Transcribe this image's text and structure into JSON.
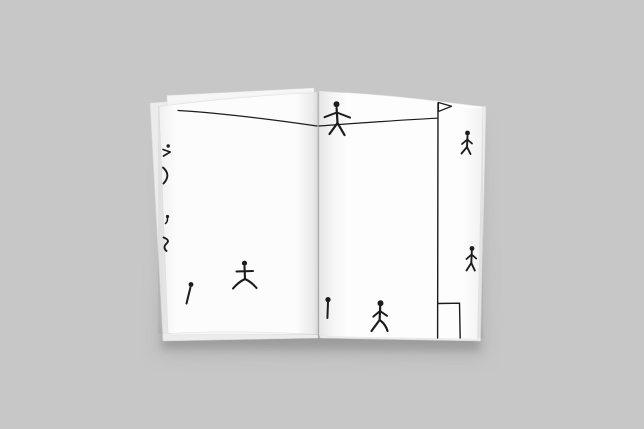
{
  "scene": {
    "description": "Photograph of an open white sketchbook on a gray surface, pages covered with small hand-drawn black stick figures, a rope line, a pennant flag on a pole and a small goal box",
    "background_color": "#c7c7c7",
    "page_color": "#fcfcfc",
    "page_color_right": "#fdfdfd",
    "under_page_color": "#ececec",
    "upper_back_page_color": "#f6f6f6",
    "ink_color": "#1c1c1c"
  },
  "drawing": {
    "elements": [
      {
        "name": "rope-line-left-page",
        "strokes": [
          {
            "kind": "path",
            "d": "M178,110.5 C220,113 272,119.5 317,126",
            "w": 1.2
          }
        ]
      },
      {
        "name": "rope-line-right-page",
        "strokes": [
          {
            "kind": "path",
            "d": "M319,126 C360,123 400,120 437,118.2",
            "w": 1.2
          }
        ]
      },
      {
        "name": "tightrope-walker-figure",
        "strokes": [
          {
            "kind": "dot",
            "cx": 336.5,
            "cy": 104.2,
            "r": 3
          },
          {
            "kind": "path",
            "d": "M336.6,108 L337.5,123",
            "w": 2.2
          },
          {
            "kind": "path",
            "d": "M324.5,117.2 L336.8,112.5 L350,117.6",
            "w": 2.0
          },
          {
            "kind": "path",
            "d": "M337.5,123 L329.5,134",
            "w": 2.2
          },
          {
            "kind": "path",
            "d": "M337.5,123 L344.5,135",
            "w": 2.2
          }
        ]
      },
      {
        "name": "flag-pole",
        "strokes": [
          {
            "kind": "path",
            "d": "M438,103 L437.6,338",
            "w": 1.4
          }
        ]
      },
      {
        "name": "flag-pennant",
        "strokes": [
          {
            "kind": "path",
            "d": "M438.4,102.5 L451.5,106.3 L438.4,111.5 Z",
            "w": 1.3,
            "fill": "#ffffff"
          }
        ]
      },
      {
        "name": "goal-box-lines",
        "strokes": [
          {
            "kind": "path",
            "d": "M438,303.5 L459.5,303.2 L460.2,338",
            "w": 1.4
          }
        ]
      },
      {
        "name": "pin-figure",
        "strokes": [
          {
            "kind": "dot",
            "cx": 328,
            "cy": 299.6,
            "r": 2.6
          },
          {
            "kind": "path",
            "d": "M328,302.5 L327.4,318",
            "w": 2.0
          }
        ]
      },
      {
        "name": "running-figure-bottom",
        "strokes": [
          {
            "kind": "dot",
            "cx": 380.5,
            "cy": 303.2,
            "r": 3
          },
          {
            "kind": "path",
            "d": "M380.2,306.5 L379.6,320",
            "w": 2.2
          },
          {
            "kind": "path",
            "d": "M380,311 L373.3,316.6",
            "w": 2.0
          },
          {
            "kind": "path",
            "d": "M380,311 L387,315.8",
            "w": 2.0
          },
          {
            "kind": "path",
            "d": "M379.6,320 L371.5,331",
            "w": 2.2
          },
          {
            "kind": "path",
            "d": "M379.6,320 Q385.5,324 387.5,331",
            "w": 2.2
          }
        ]
      },
      {
        "name": "wide-stance-figure",
        "strokes": [
          {
            "kind": "dot",
            "cx": 244.5,
            "cy": 263.2,
            "r": 2.6
          },
          {
            "kind": "path",
            "d": "M244.5,266.5 L245,279",
            "w": 2.1
          },
          {
            "kind": "path",
            "d": "M236.5,271.5 L253,271",
            "w": 2.0
          },
          {
            "kind": "path",
            "d": "M245,279 Q238.5,282 233,288.5",
            "w": 2.1
          },
          {
            "kind": "path",
            "d": "M245,279 Q251.5,282 256.5,288",
            "w": 2.1
          }
        ]
      },
      {
        "name": "leaning-line-figure",
        "strokes": [
          {
            "kind": "dot",
            "cx": 191,
            "cy": 284.5,
            "r": 2.4
          },
          {
            "kind": "path",
            "d": "M190.4,287.5 L186.5,303.5",
            "w": 2.0
          }
        ]
      },
      {
        "name": "edge-runner-figure-top",
        "strokes": [
          {
            "kind": "dot",
            "cx": 467.5,
            "cy": 133,
            "r": 2.4
          },
          {
            "kind": "path",
            "d": "M467.5,136 L467,147",
            "w": 1.9
          },
          {
            "kind": "path",
            "d": "M467.3,139.5 L462,144",
            "w": 1.8
          },
          {
            "kind": "path",
            "d": "M467.3,139.5 L472,143.5",
            "w": 1.8
          },
          {
            "kind": "path",
            "d": "M467,147 L461.5,153.5",
            "w": 1.9
          },
          {
            "kind": "path",
            "d": "M467,147 L470.5,154",
            "w": 1.9
          }
        ]
      },
      {
        "name": "edge-walker-figure-bottom",
        "strokes": [
          {
            "kind": "dot",
            "cx": 472,
            "cy": 248.5,
            "r": 2.4
          },
          {
            "kind": "path",
            "d": "M471.8,251.5 L471.3,263",
            "w": 1.9
          },
          {
            "kind": "path",
            "d": "M471.6,254.5 L466.5,259",
            "w": 1.8
          },
          {
            "kind": "path",
            "d": "M471.6,254.5 L476.2,258.5",
            "w": 1.8
          },
          {
            "kind": "path",
            "d": "M471.3,263 L466.5,270.5",
            "w": 1.9
          },
          {
            "kind": "path",
            "d": "M471.3,263 L474.8,270.5",
            "w": 1.9
          }
        ]
      },
      {
        "name": "clipped-figure-mark-1",
        "strokes": [
          {
            "kind": "dot",
            "cx": 168.2,
            "cy": 146,
            "r": 1.7
          },
          {
            "kind": "path",
            "d": "M163,149.5 L170.2,152 L163.5,156",
            "w": 1.7
          }
        ]
      },
      {
        "name": "clipped-figure-mark-2",
        "strokes": [
          {
            "kind": "path",
            "d": "M163,167.5 Q171.5,175 163.5,183.5",
            "w": 1.9
          }
        ]
      },
      {
        "name": "clipped-figure-mark-3",
        "strokes": [
          {
            "kind": "dot",
            "cx": 167.5,
            "cy": 216.5,
            "r": 1.6
          },
          {
            "kind": "path",
            "d": "M167.5,218.5 Q167.5,222 165.5,223.5",
            "w": 1.5
          }
        ]
      },
      {
        "name": "clipped-figure-mark-4",
        "strokes": [
          {
            "kind": "path",
            "d": "M163.5,237.5 Q170.5,240 166.5,243.5 Q162.5,247.5 166.5,251",
            "w": 1.9
          }
        ]
      }
    ]
  }
}
